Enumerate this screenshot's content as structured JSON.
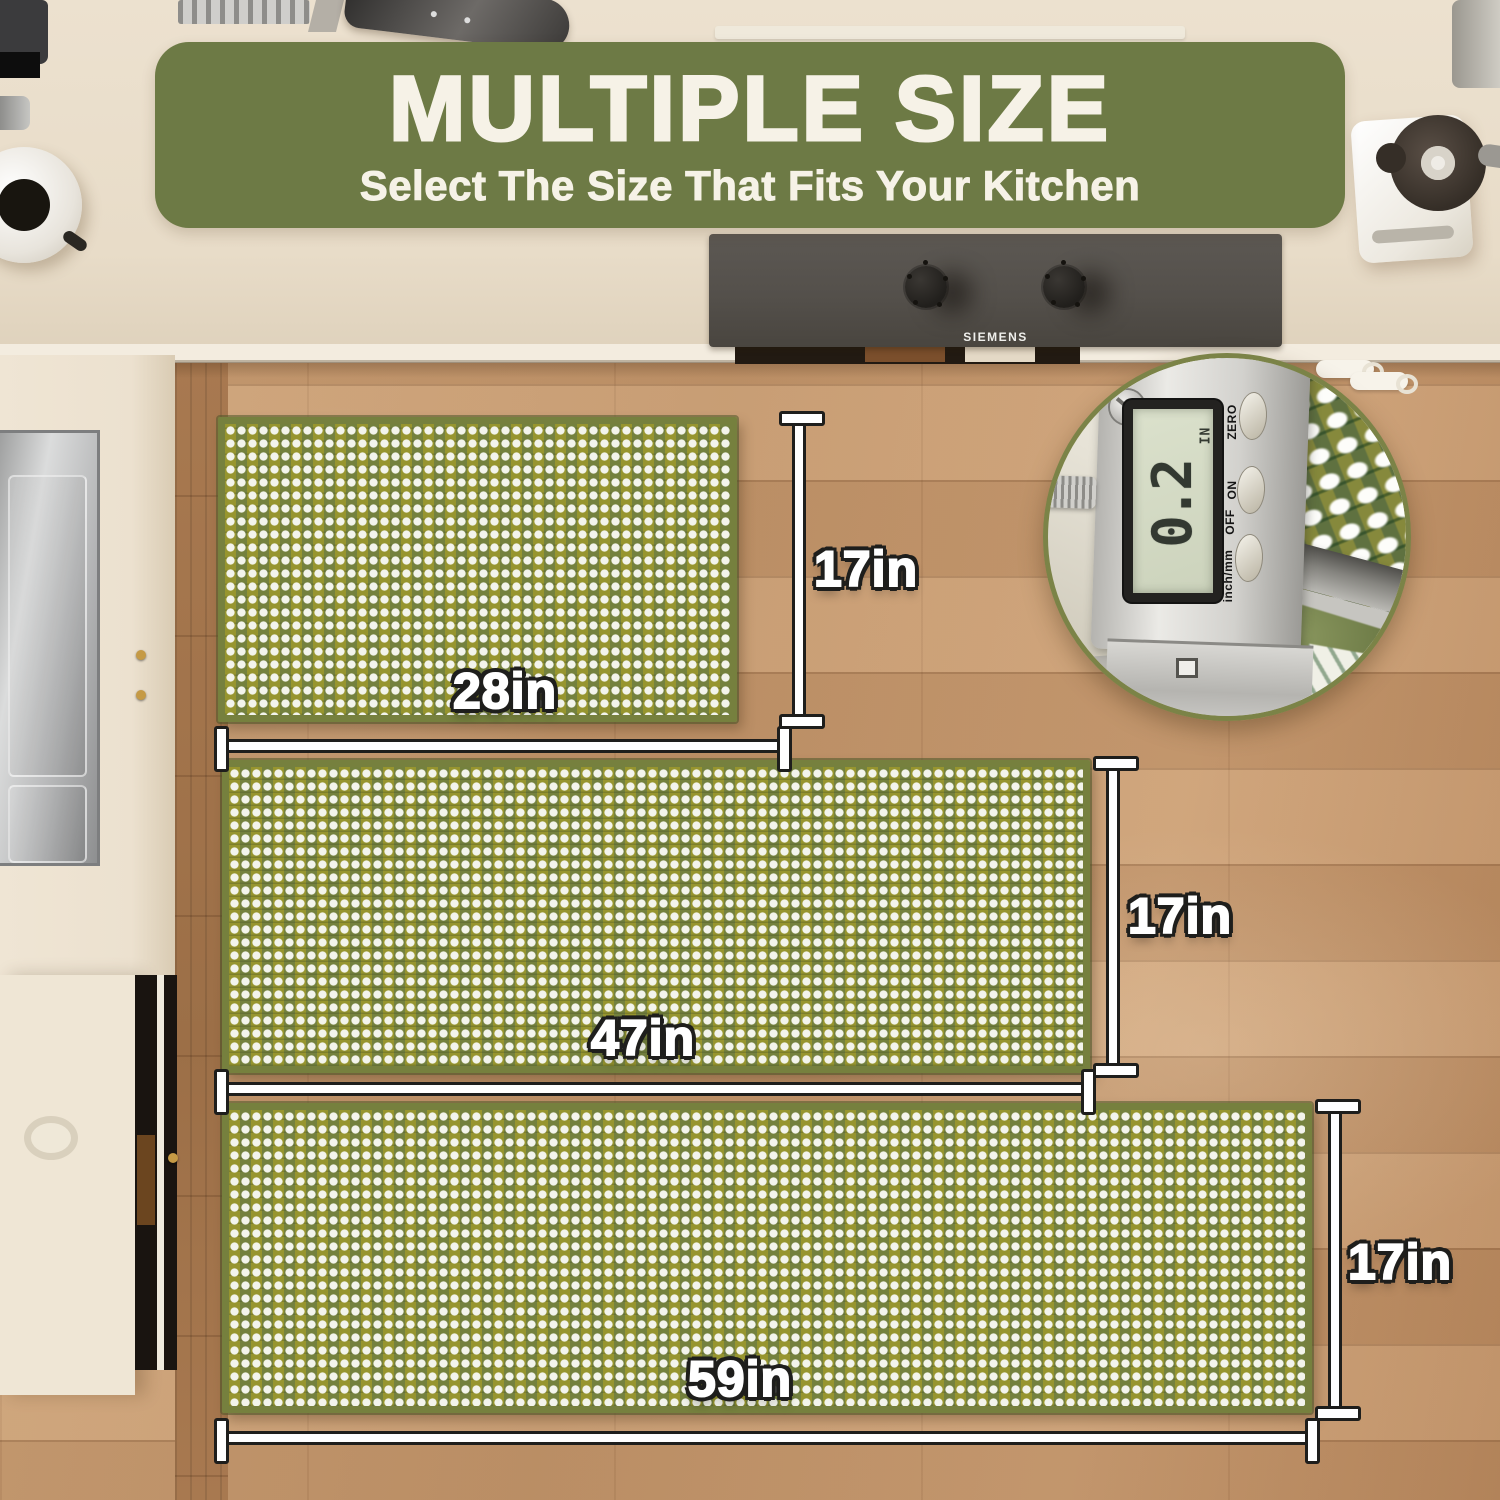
{
  "banner": {
    "title": "MULTIPLE SIZE",
    "subtitle": "Select The Size That Fits Your Kitchen"
  },
  "cooktop": {
    "brand": "SIEMENS"
  },
  "inset": {
    "reading": "0.2",
    "unit": "IN",
    "labels": {
      "zero": "ZERO",
      "on": "ON",
      "off": "OFF",
      "mode": "inch/mm"
    }
  },
  "mats": [
    {
      "id": "small",
      "width_label": "28in",
      "height_label": "17in"
    },
    {
      "id": "medium",
      "width_label": "47in",
      "height_label": "17in"
    },
    {
      "id": "large",
      "width_label": "59in",
      "height_label": "17in"
    }
  ],
  "colors": {
    "banner_green": "#6d7a45",
    "mat_olive": "#97952f",
    "mat_alt_green": "#74813e",
    "mat_white": "#f3f4ec",
    "mat_border": "#76803e",
    "floor_wood": "#c89a6f",
    "counter_cream": "#e9decb",
    "dimension_white": "#ffffff",
    "dimension_outline": "#1e1e1c"
  }
}
